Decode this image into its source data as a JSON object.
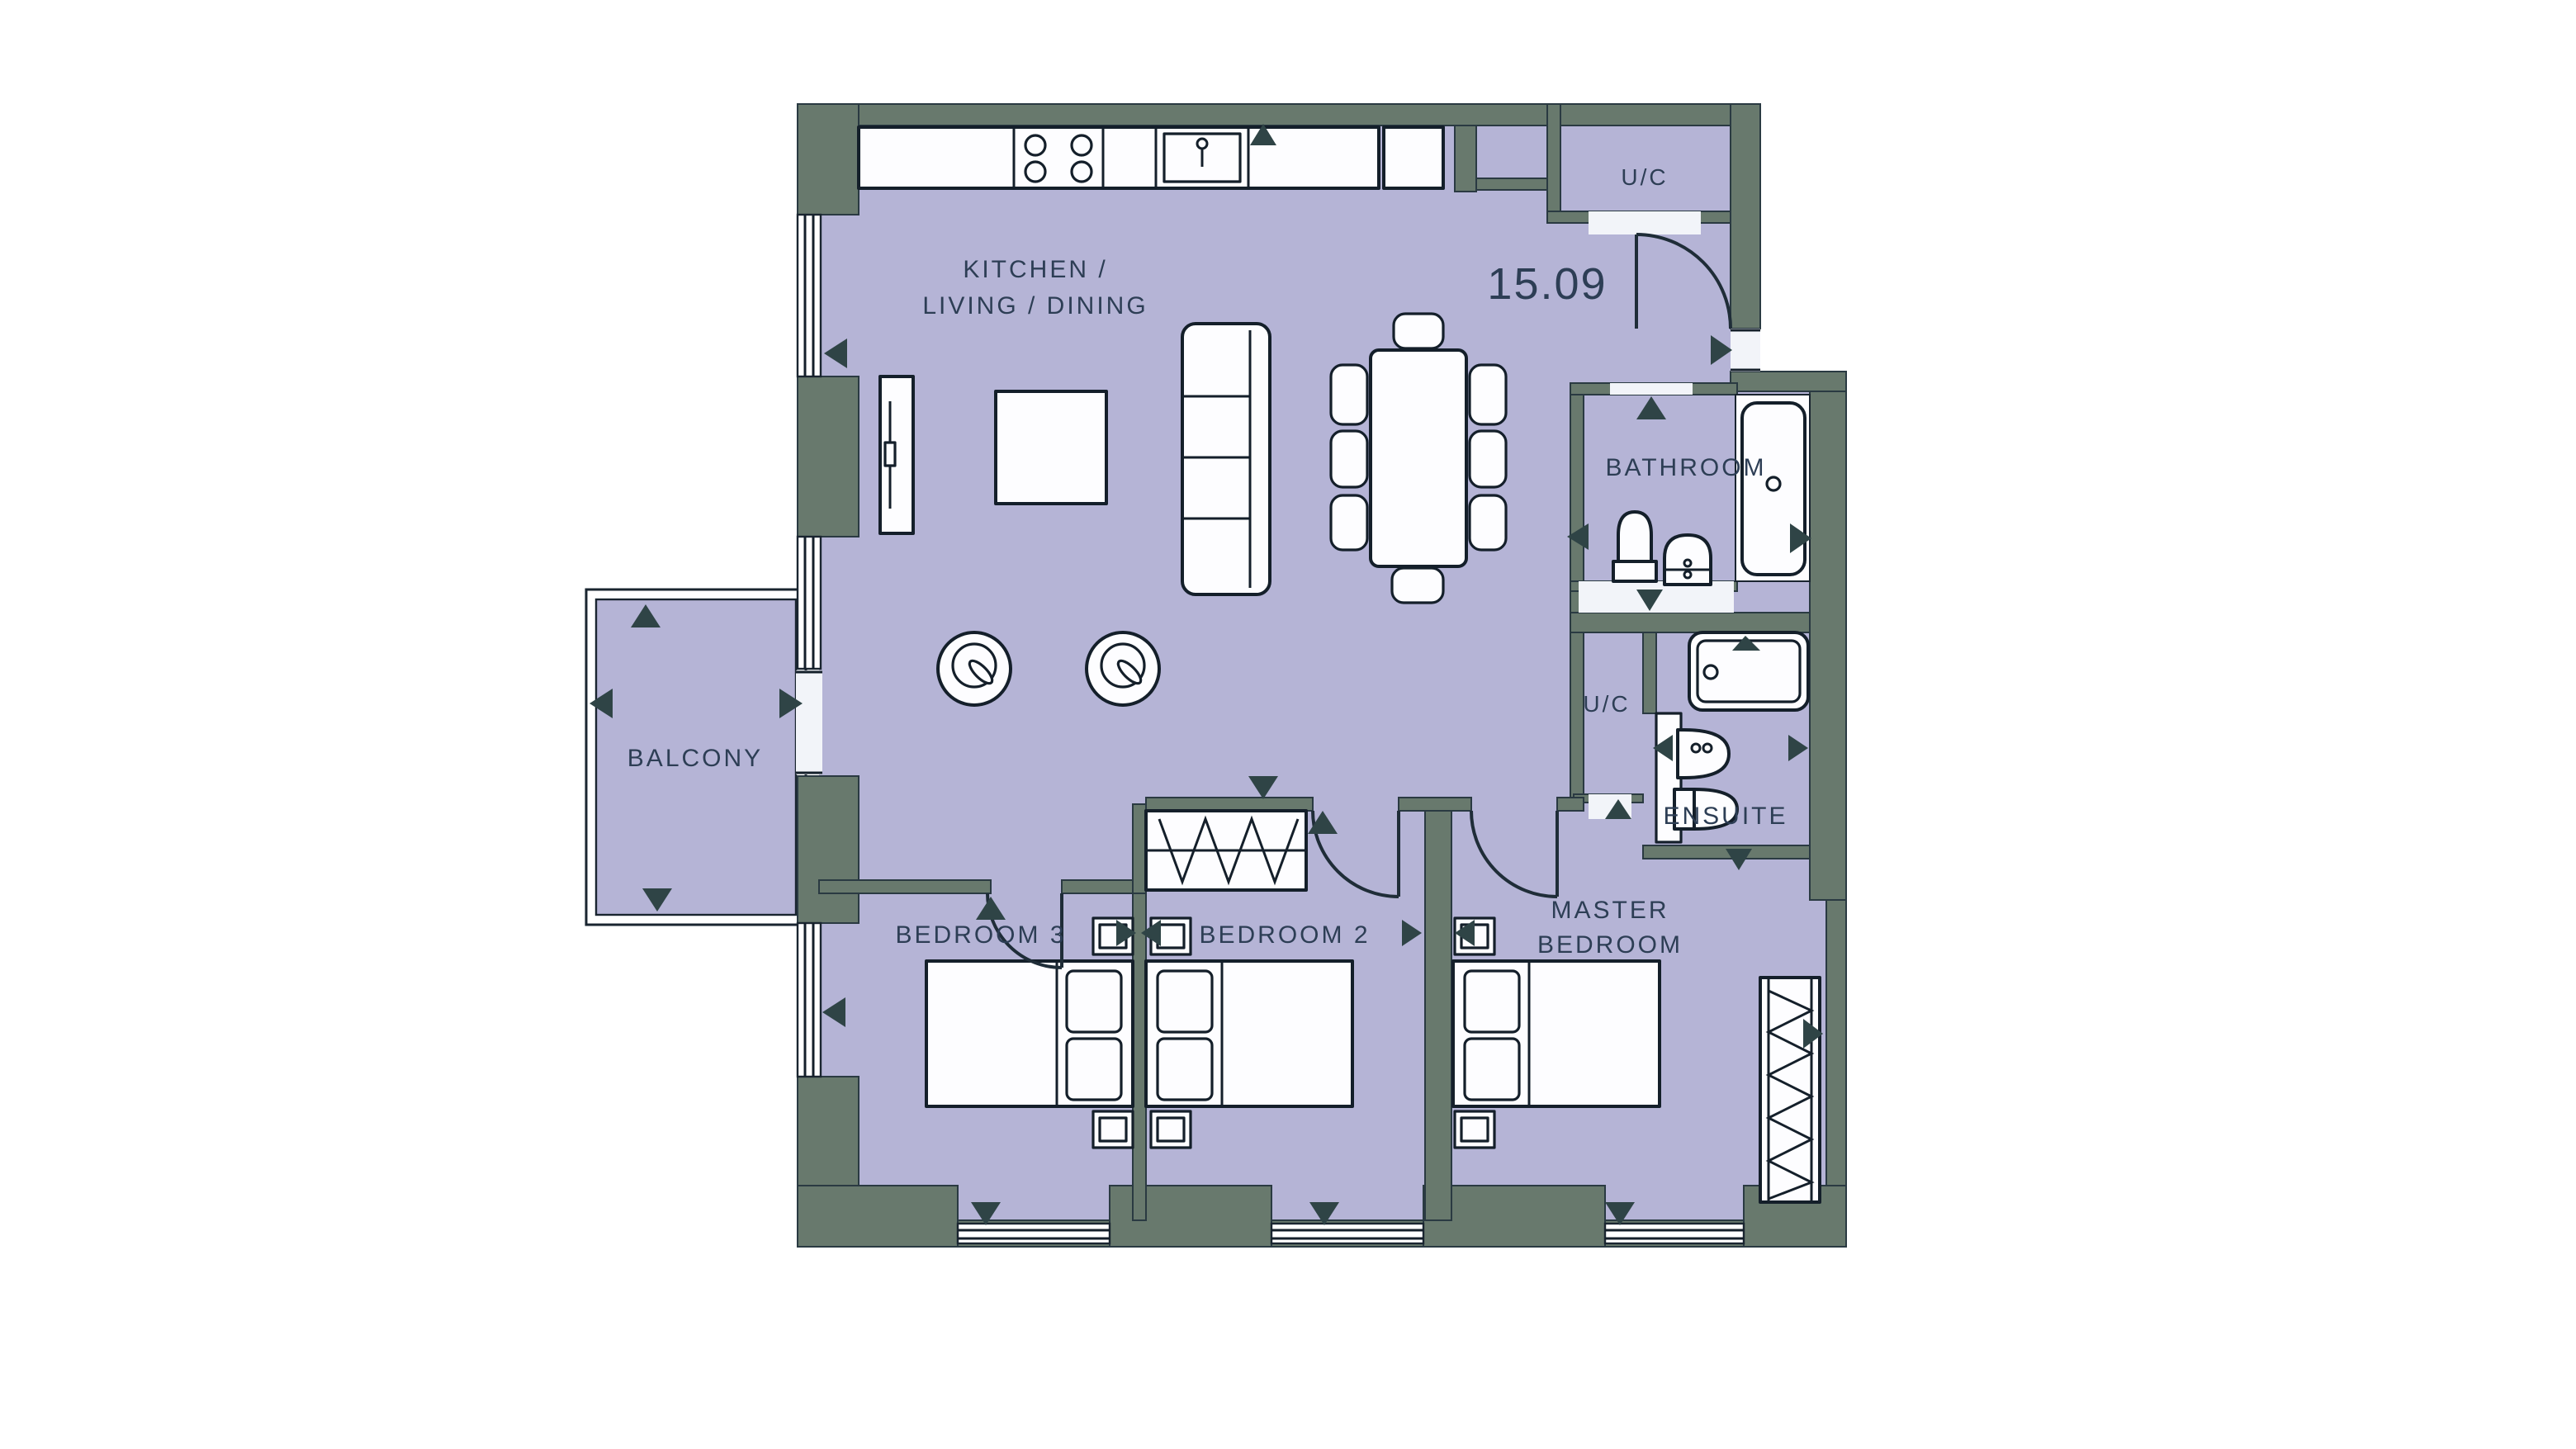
{
  "plan": {
    "unit_number": "15.09",
    "rooms": {
      "kitchen": {
        "line1": "KITCHEN /",
        "line2": "LIVING / DINING"
      },
      "balcony": {
        "label": "BALCONY"
      },
      "bathroom": {
        "label": "BATHROOM"
      },
      "ensuite": {
        "label": "ENSUITE"
      },
      "utility_hall": {
        "label": "U/C"
      },
      "utility_corridor": {
        "label": "U/C"
      },
      "master_bedroom": {
        "line1": "MASTER",
        "line2": "BEDROOM"
      },
      "bedroom2": {
        "label": "BEDROOM 2"
      },
      "bedroom3": {
        "label": "BEDROOM 3"
      }
    },
    "colors": {
      "background": "#ffffff",
      "floor": "#b5b4d6",
      "wall": "#68796d",
      "outline": "#1a2530",
      "fixture_fill": "#fdfdff",
      "label_text": "#2d3e55",
      "arrow": "#2f4446"
    }
  }
}
